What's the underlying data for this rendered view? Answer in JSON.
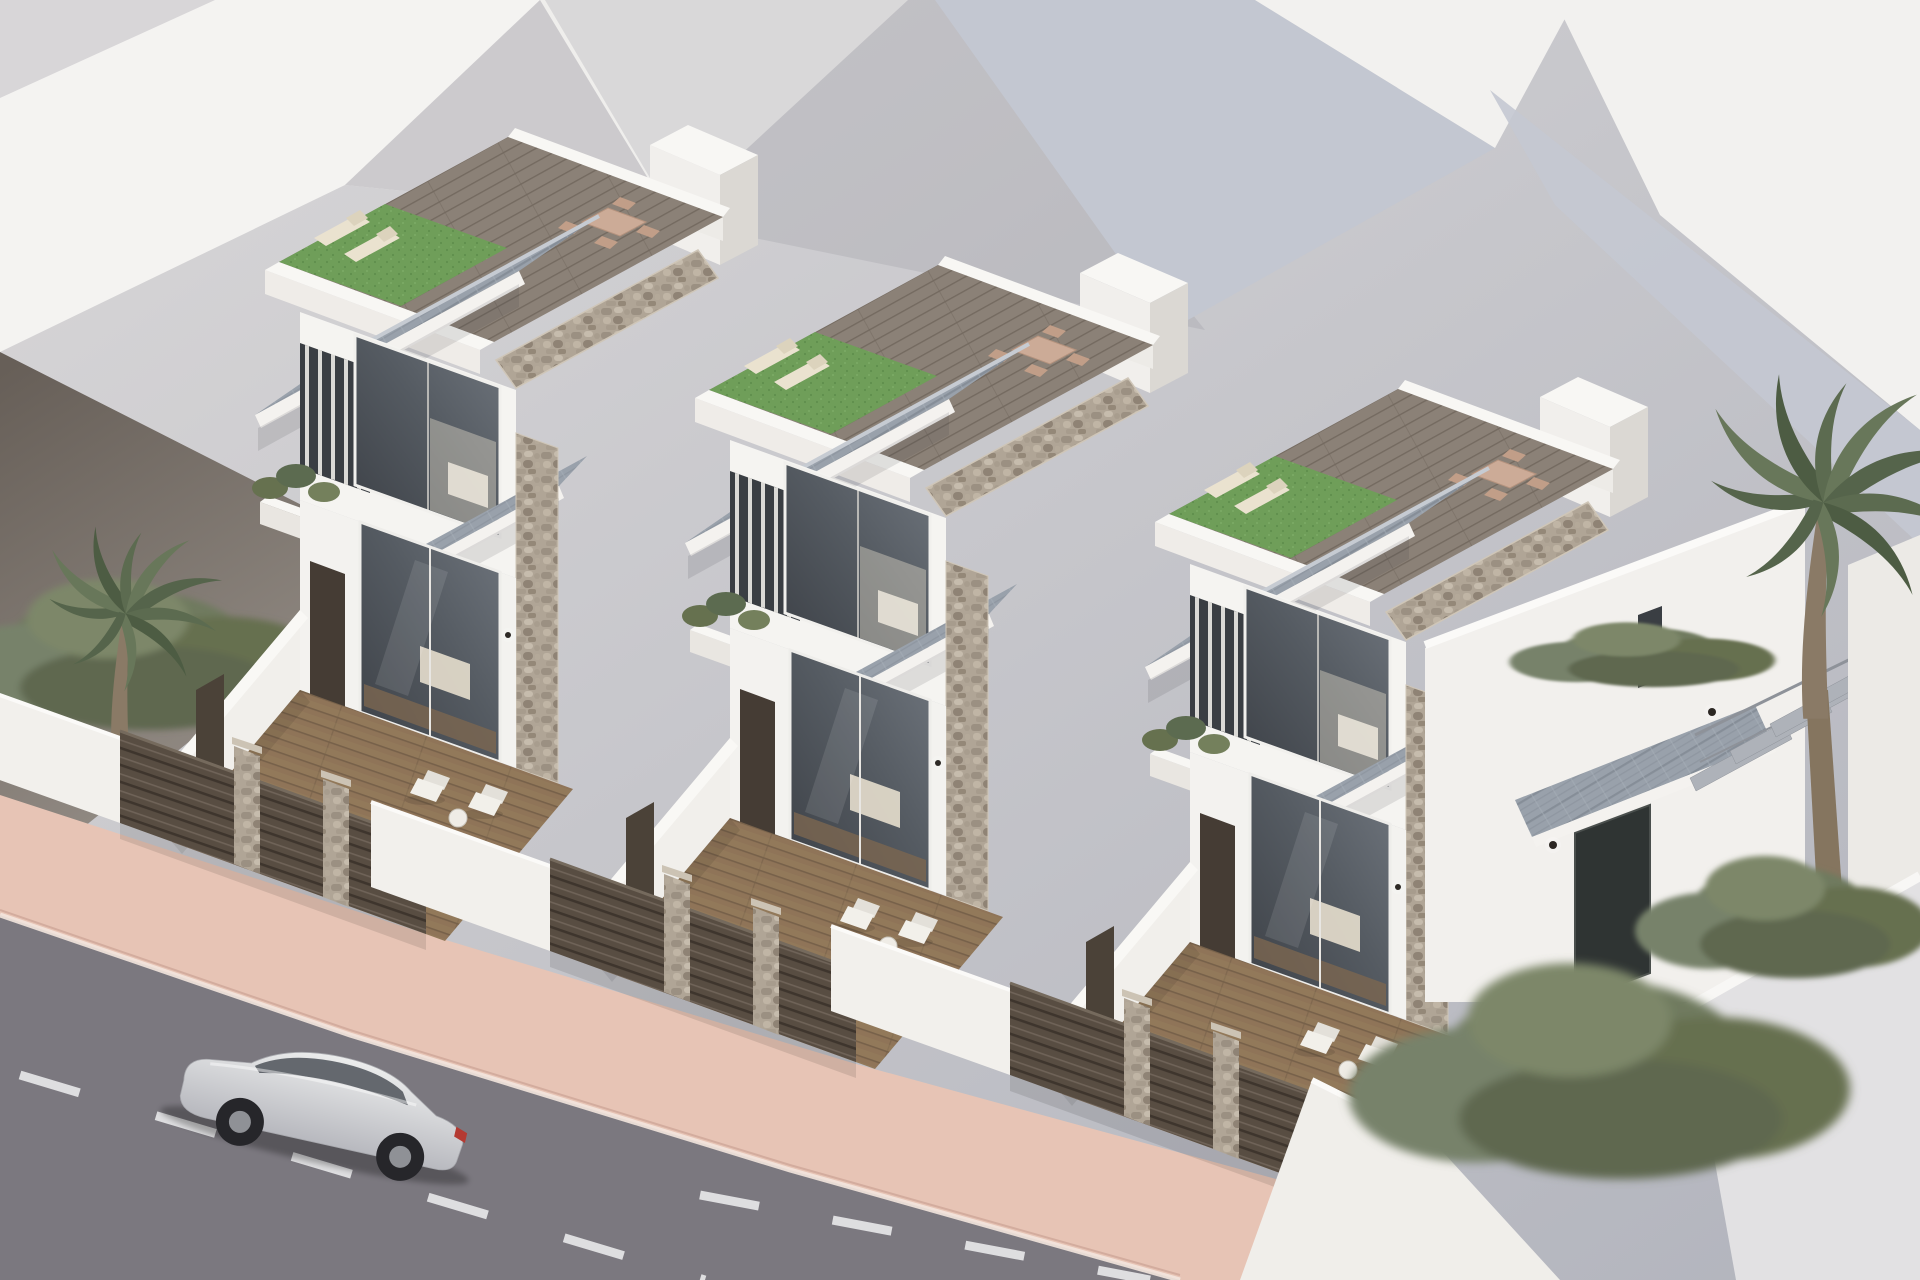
{
  "scene": {
    "kind": "3d-architectural-visualization",
    "subject": "Row of three identical modern two-storey villas, each with private plunge pool, timber deck terrace and rooftop solarium",
    "view": "aerial three-quarter view",
    "time_of_day": "daytime"
  },
  "villas": [
    {
      "id": "villa-1",
      "position": "rear-left"
    },
    {
      "id": "villa-2",
      "position": "middle"
    },
    {
      "id": "villa-3",
      "position": "front-right with side entrance, canopy and open stair"
    }
  ],
  "villa_features": {
    "walls": "white render with natural stone cladding accents",
    "roof": "grey tiled mono-pitch roof with white fascia",
    "rooftop_solarium": [
      "artificial turf",
      "timber deck",
      "2 sun loungers",
      "dining table with 4 chairs",
      "white parapet",
      "stair bulkhead"
    ],
    "upper_floor": [
      "large glazed bedroom window",
      "vertical louver screen",
      "balcony planter with greenery"
    ],
    "ground_floor": [
      "glazed sliding doors",
      "entry door",
      "wall lights",
      "tiled entrance awning"
    ],
    "terrace": [
      "turquoise plunge pool with steps",
      "timber deck",
      "2 white armchairs",
      "side table",
      "potted plant",
      "garden gate"
    ],
    "street_boundary": "dark slatted fence with stone pillars and white rendered walls"
  },
  "vehicle": {
    "type": "SUV",
    "color_name": "silver",
    "location": "driving on street, bottom-left"
  },
  "street": {
    "surface": "asphalt",
    "markings": "white dashed lane lines",
    "sidewalk": "terracotta-pink pavement with light curb"
  },
  "vegetation": {
    "palm_trees": 2,
    "hedges": [
      "left boundary hedge",
      "right boundary hedges"
    ],
    "planters": "balcony and terrace pots"
  },
  "background": {
    "buildings": "abstract white massing volumes with grey shadow facets"
  },
  "palette": {
    "sky_top": "#d9d7d8",
    "sky_bottom": "#b2b4bd",
    "dark_wall_top": "#675f58",
    "dark_wall_bottom": "#99928b",
    "villa_white": "#f5f4f1",
    "roof_tile": "#99a1ab",
    "roof_tile_dark": "#868e98",
    "stone": "#b0a596",
    "wood_ground": "#8f7458",
    "wood_roof": "#8b8177",
    "turf": "#6f9e59",
    "pool_light": "#9fdde6",
    "pool_deep": "#1f8fae",
    "fence": "#584d42",
    "sidewalk": "#e7c4b5",
    "road": "#7b787f",
    "road_dark": "#6d6a71",
    "marking": "#e9e9eb",
    "glass_dark": "#3c4046",
    "glass_light": "#6f757d",
    "car_light": "#eceded",
    "car_dark": "#b7b8be",
    "hedge_green": "#6f7a5e",
    "palm_green": "#5c6b50",
    "door_dark": "#453c34"
  }
}
